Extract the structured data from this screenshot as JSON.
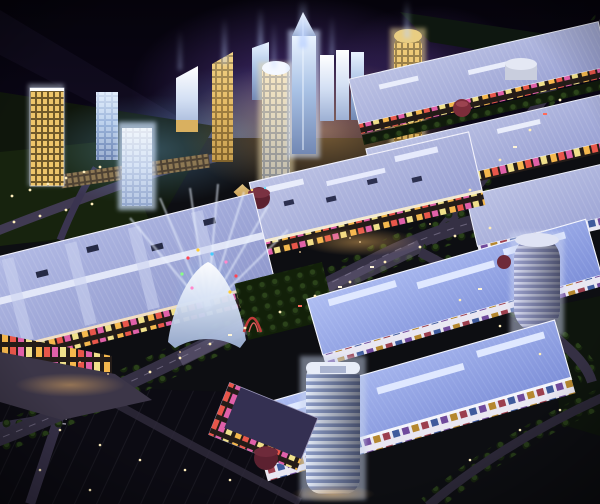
{
  "meta": {
    "domain": "Natural-Image",
    "description": "Night-time aerial architectural rendering of a large mixed-use retail development: a cluster of illuminated glass and gold skyscrapers with searchlight beams rises behind rows of big-box shopping mall buildings with glowing lavender-blue ribbed roofs, billboard-lined facades, tree-lined boulevards, plazas, dark parking lots and cylindrical office towers.",
    "time_of_day": "night",
    "view": "aerial oblique"
  },
  "palette": {
    "sky_top": "#05030b",
    "sky_glow": "#6a3fb0",
    "ground": "#0d0e12",
    "hill": "#0f160c",
    "lawn": "#17230e",
    "plaza_green": "#122009",
    "parking": "#0c0b13",
    "road": "#353044",
    "road_lit": "#6b6180",
    "road_faint": "#2c2838",
    "roof_lavender": "#9aa3d6",
    "roof_blue": "#8496de",
    "skylight": "#e9edfb",
    "cornice": "#f7f5ff",
    "facade_dark": "#241c18",
    "poster_gold": "#f5b84d",
    "poster_red": "#e8564a",
    "glass_white": "#eef4ff",
    "glass_blue": "#a9c4e8",
    "gold": "#d9ad5e",
    "warm_light": "#ffd98e",
    "beam_blue": "#bcd2ff",
    "drum_red": "#5c2130",
    "arch_red": "#c23b3b",
    "white_drum": "#e4e8f4"
  },
  "scene": {
    "sky": {
      "haze": "violet searchlight haze over tower cluster",
      "light_beams": 8
    },
    "tower_cluster": {
      "count": 12,
      "styles": [
        "blue glass",
        "white glass",
        "gold"
      ],
      "tallest": "spire tower with vertical search beam",
      "podium": "gold-lit curved retail crescent"
    },
    "malls": {
      "left_mega_mall": "ribbed lavender roof, skylight strips, billboard facade",
      "central_mall": "ribbed roof, warm entrance facade, dark-red corner drum",
      "northeast_rows": 3,
      "southeast_rows": 2,
      "corner_mall": "poster facade with dark-red drum"
    },
    "landmarks": {
      "feature_pavilion": "white arched entrance with criss-cross searchlights and balloons",
      "red_arch": "red gateway sculpture",
      "white_drum_building": "circular white rotunda",
      "gold_cylinder_tower": "rounded gold tower",
      "rounded_office_tower": "banded rounded tower, south-east",
      "right_cylinder_tower": "banded cylinder tower, east",
      "red_gazebo": "small red-roofed pavilion"
    },
    "circulation": {
      "main_boulevard": "tree-lined lit boulevard, south-west to north-east",
      "northeast_highway": "curving road with car lights",
      "southeast_branch": "road along south-east mall row",
      "parking_lot": "dark lot with sparse lights, south-west",
      "streetlights": "warm point lights",
      "cars": "scattered white and red headlights"
    }
  }
}
